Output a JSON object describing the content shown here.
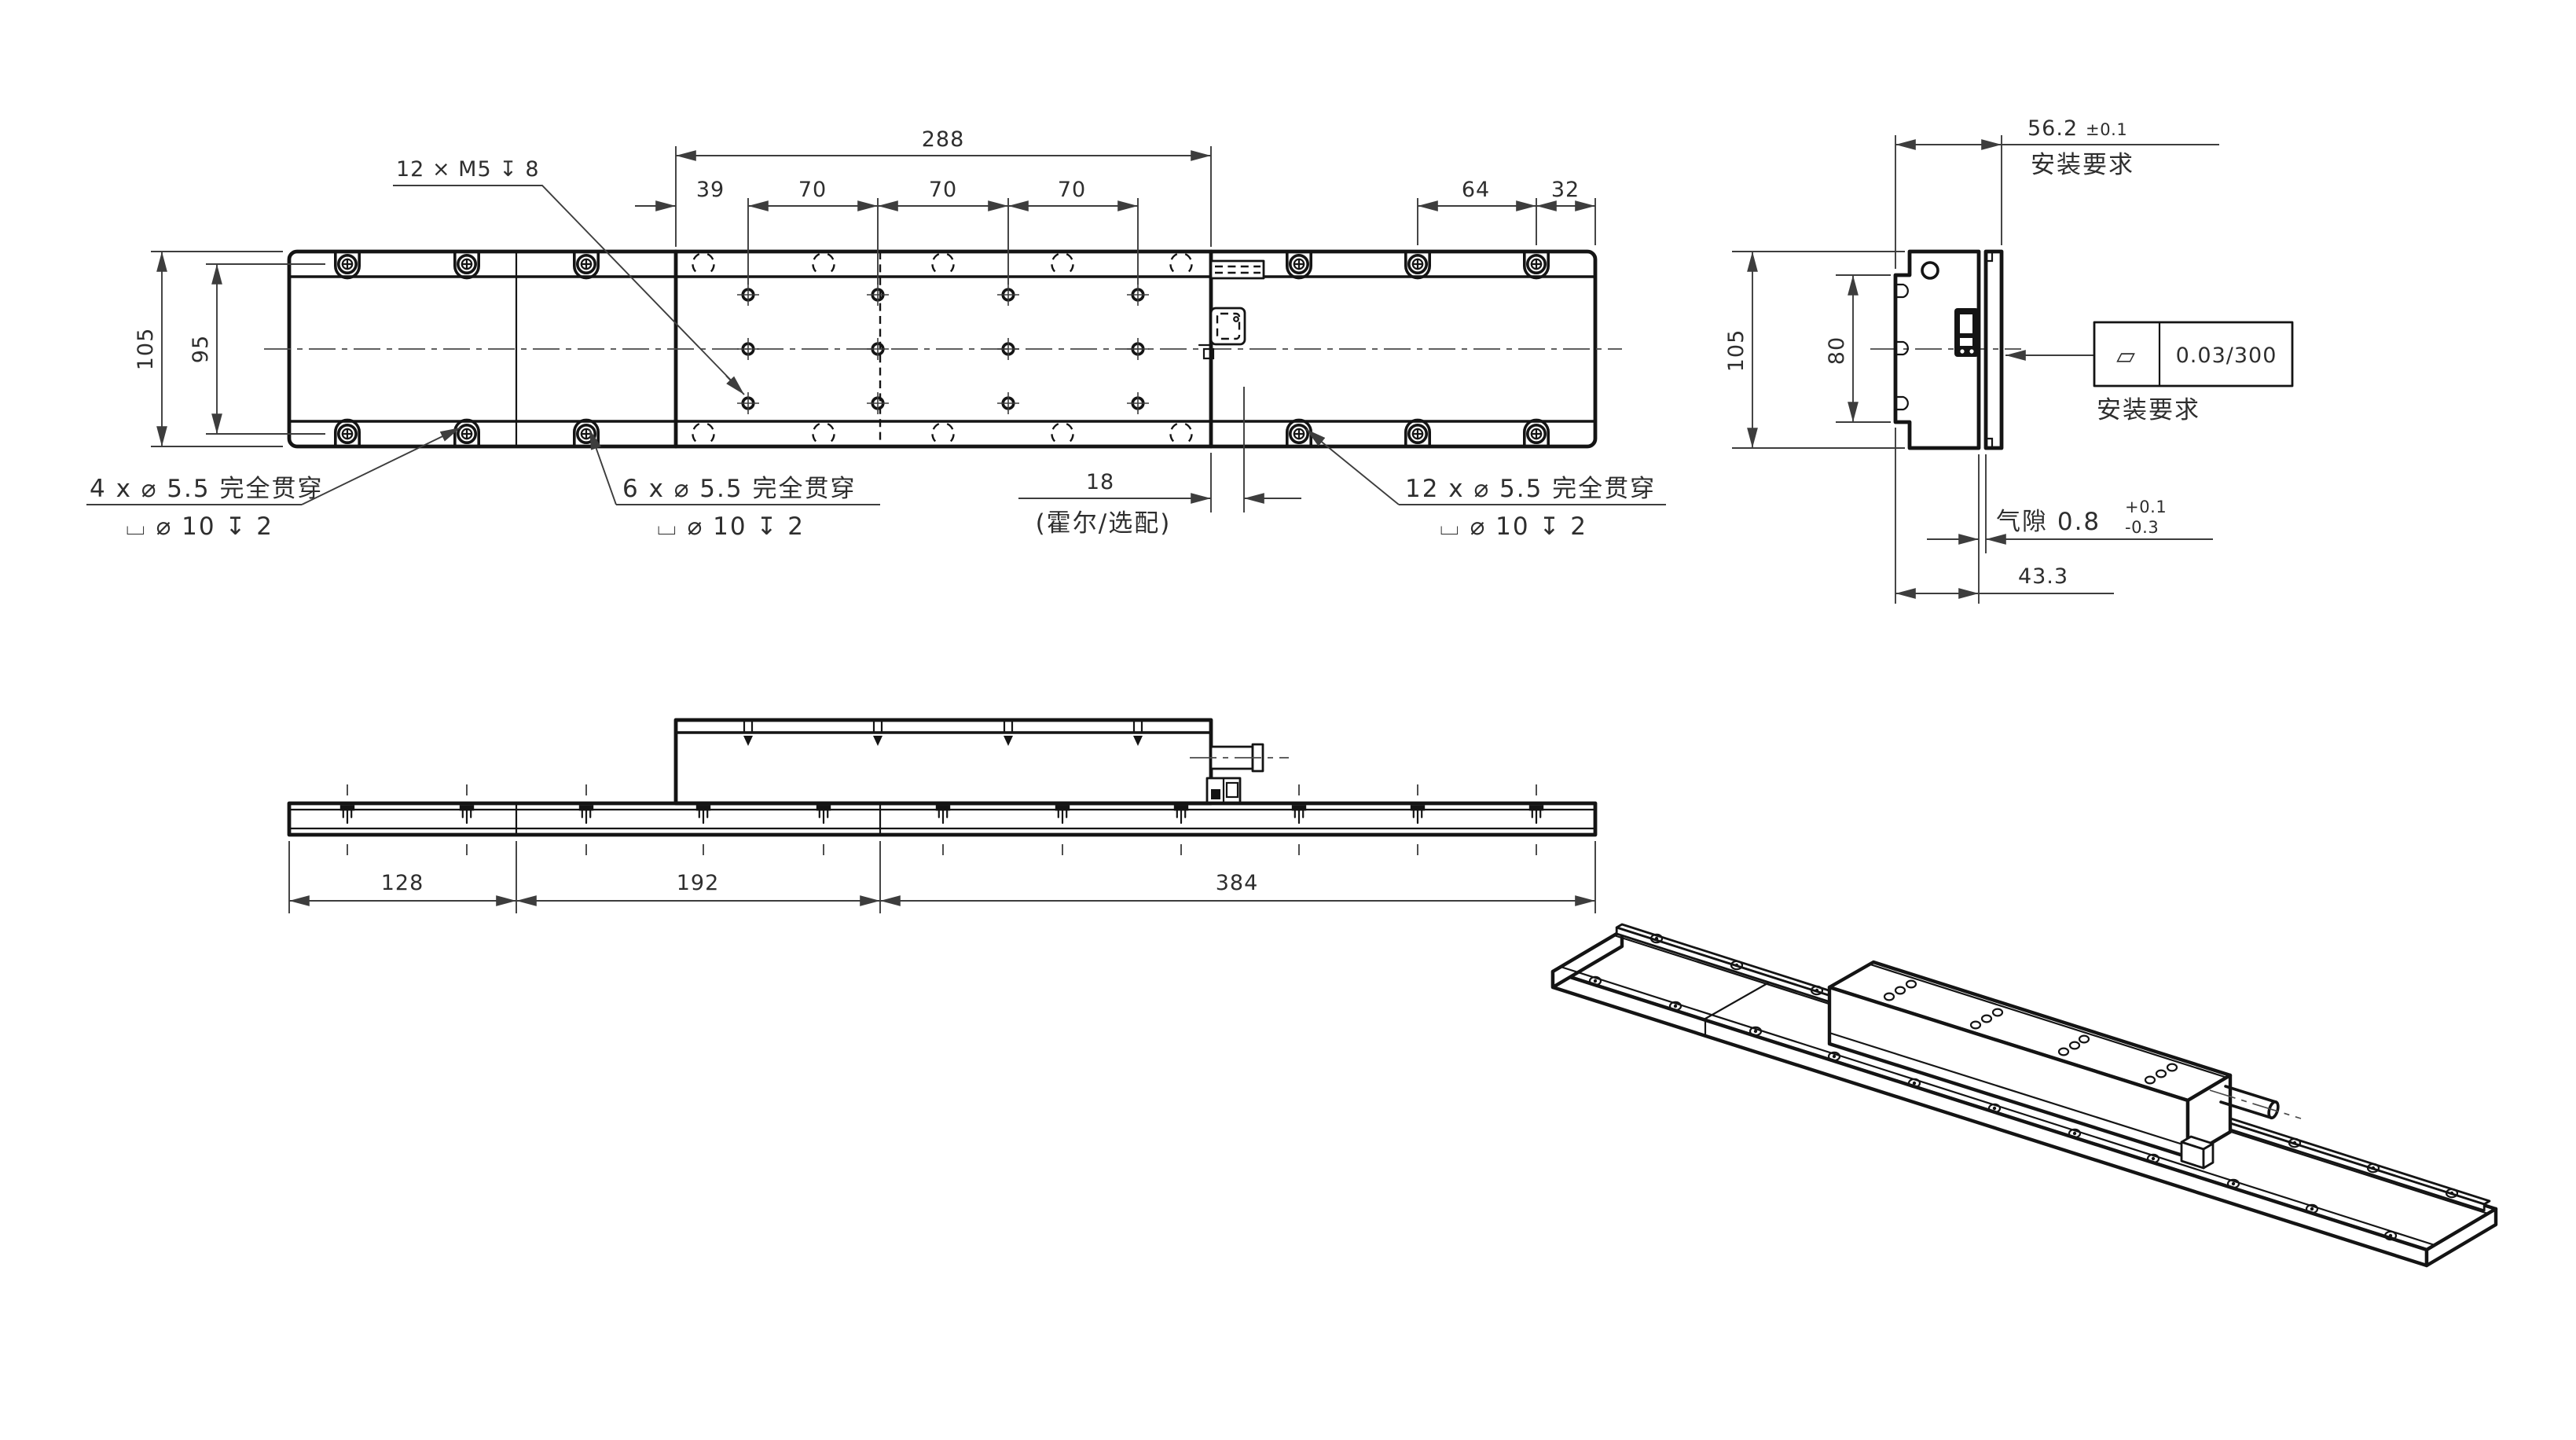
{
  "top_view": {
    "dim_288": "288",
    "dim_39": "39",
    "dim_70a": "70",
    "dim_70b": "70",
    "dim_70c": "70",
    "dim_64": "64",
    "dim_32": "32",
    "dim_width_outer": "105",
    "dim_width_inner": "95",
    "thread_callout": "12 × M5 ↧ 8",
    "callout_4x_line1": "4 x ⌀ 5.5 完全贯穿",
    "callout_4x_line2": "⌴ ⌀ 10  ↧ 2",
    "callout_6x_line1": "6 x ⌀ 5.5 完全贯穿",
    "callout_6x_line2": "⌴ ⌀ 10  ↧ 2",
    "callout_12x_line1": "12 x ⌀ 5.5 完全贯穿",
    "callout_12x_line2": "⌴ ⌀ 10  ↧ 2",
    "dim_hall": "18",
    "hall_note": "(霍尔/选配)"
  },
  "end_view": {
    "dim_overall": "56.2",
    "dim_overall_tol": "±0.1",
    "note_mount_top": "安装要求",
    "dim_height": "105",
    "dim_inner": "80",
    "flatness_symbol": "▱",
    "flatness_value": "0.03/300",
    "note_mount_side": "安装要求",
    "airgap_label": "气隙 0.8",
    "airgap_tol_plus": "+0.1",
    "airgap_tol_minus": "-0.3",
    "dim_body": "43.3"
  },
  "bottom_view": {
    "dim_seg1": "128",
    "dim_seg2": "192",
    "dim_seg3": "384"
  },
  "colors": {
    "line": "#141414",
    "dim": "#3d3d3d",
    "background": "#ffffff"
  }
}
